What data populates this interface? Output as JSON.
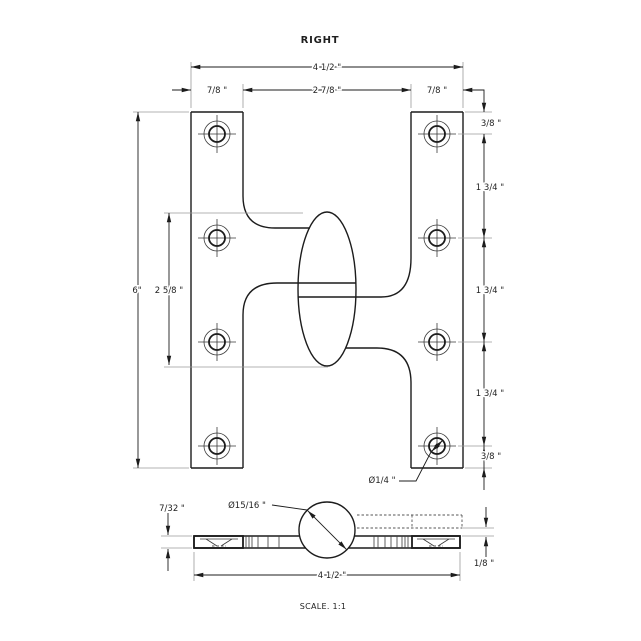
{
  "title": "RIGHT",
  "scale_label": "SCALE. 1:1",
  "front_view": {
    "width_total": "4 1/2 \"",
    "width_left_leaf": "7/8 \"",
    "width_gap": "2 7/8 \"",
    "width_right_leaf": "7/8 \"",
    "height_total": "6\"",
    "knuckle_height": "2 5/8 \"",
    "margin_top": "3/8 \"",
    "pitch_1": "1 3/4 \"",
    "pitch_2": "1 3/4 \"",
    "pitch_3": "1 3/4 \"",
    "margin_bottom": "3/8 \"",
    "hole_diameter": "Ø1/4 \""
  },
  "side_view": {
    "leaf_thickness": "7/32 \"",
    "knuckle_diameter": "Ø15/16 \"",
    "width_total": "4 1/2 \"",
    "leaf_offset": "1/8 \""
  },
  "colors": {
    "line": "#1c1c1c",
    "extension": "#9b9b9b",
    "background": "#ffffff"
  }
}
